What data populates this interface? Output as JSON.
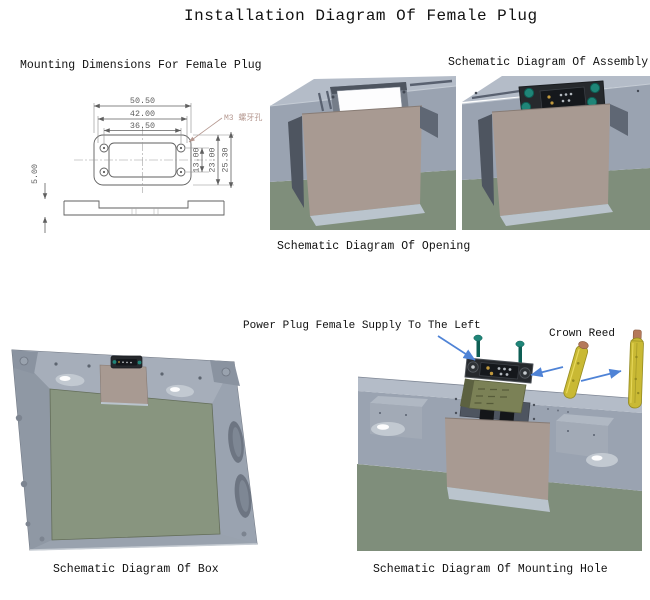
{
  "title": "Installation Diagram Of Female Plug",
  "sections": {
    "mounting_dimensions": {
      "caption": "Mounting Dimensions For Female Plug",
      "dims": {
        "width_outer": "50.50",
        "width_holes": "42.00",
        "width_inner": "36.50",
        "height_inner": "13.00",
        "height_mid": "23.00",
        "height_outer": "25.30",
        "flange_thickness": "5.00",
        "hole_note": "M3 螺牙孔"
      }
    },
    "opening": {
      "caption": "Schematic Diagram Of Opening"
    },
    "assembly": {
      "caption": "Schematic Diagram Of Assembly"
    },
    "box": {
      "caption": "Schematic Diagram Of Box"
    },
    "mounting_hole": {
      "caption": "Schematic Diagram Of Mounting Hole",
      "callout_plug": "Power Plug Female Supply To The Left",
      "callout_reed": "Crown Reed"
    }
  },
  "colors": {
    "text": "#111111",
    "dim_text": "#5d5d5d",
    "dim_line": "#8c8c8c",
    "draw_line": "#5f5f5f",
    "hole_note": "#b59890",
    "rail_top": "#b4bcc8",
    "rail_front": "#9aa3b1",
    "rail_dark": "#596170",
    "recess": "#4e5560",
    "plate": "#a89a92",
    "plate_edge": "#877b74",
    "lip": "#bac4cd",
    "floor": "#7f8e7b",
    "panel_green": "#88957f",
    "frame": "#99a2ae",
    "frame_light": "#a6aeba",
    "black": "#26292d",
    "inner_black": "#15181c",
    "teal": "#1f8578",
    "teal_dark": "#0e5e54",
    "olive": "#7b8156",
    "olive_dark": "#5c6140",
    "reed": "#c9b934",
    "reed_dark": "#948a20",
    "reed_hi": "#e8d95c",
    "copper": "#b5795a",
    "arrow": "#4f83d6",
    "pin_gold": "#c29a3e",
    "pin_gray": "#b3b9bf",
    "white_hole": "#fdfdfe",
    "dish": "#c2c9d1"
  }
}
